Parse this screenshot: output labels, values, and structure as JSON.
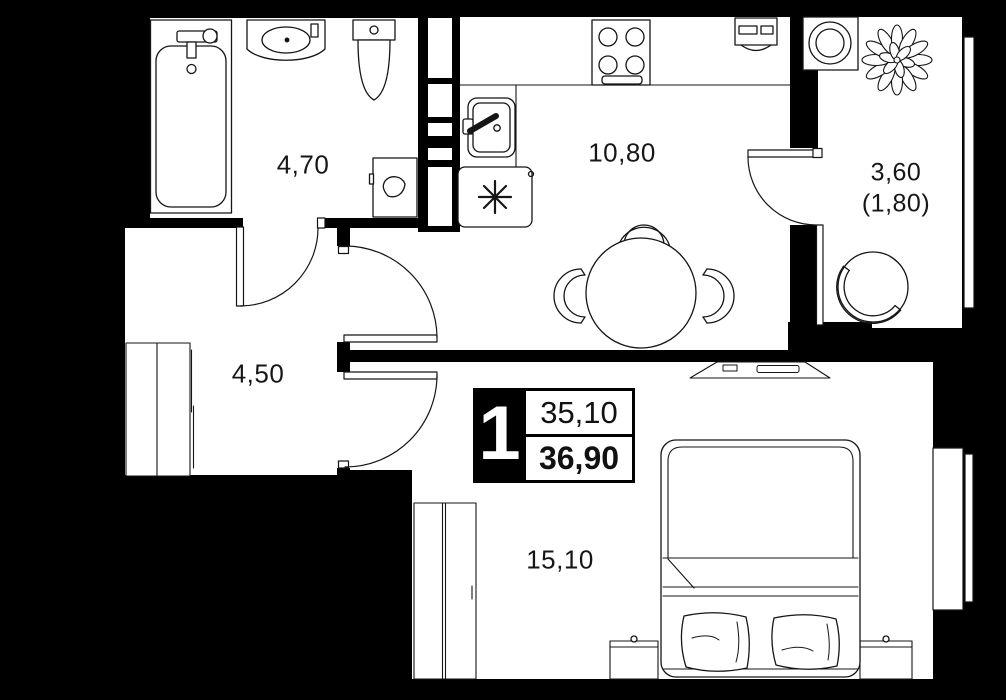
{
  "floor_plan": {
    "type": "apartment-floor-plan",
    "rooms": [
      {
        "name": "bathroom",
        "area": "4,70"
      },
      {
        "name": "kitchen",
        "area": "10,80"
      },
      {
        "name": "balcony",
        "area": "3,60",
        "area_with_coefficient": "(1,80)"
      },
      {
        "name": "hallway",
        "area": "4,50"
      },
      {
        "name": "living-room",
        "area": "15,10"
      }
    ],
    "info_box": {
      "room_count": "1",
      "living_area": "35,10",
      "total_area": "36,90"
    },
    "colors": {
      "background": "#000000",
      "floor": "#ffffff",
      "line": "#151515"
    }
  }
}
